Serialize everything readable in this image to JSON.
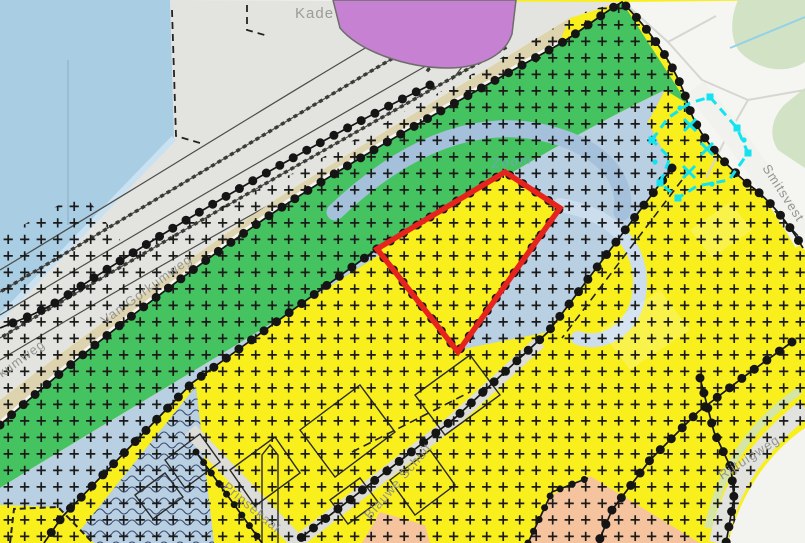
{
  "map": {
    "street_labels": {
      "kade": "Kade",
      "van_gorkumweg": "Van Gorkumweg",
      "van_gorkumweg_2": "Van Gorkumweg",
      "smitsvest": "Smitsvest",
      "rijtuigweg": "Rijtuigweg",
      "prinsekaai": "Prinsekaai",
      "blauwe_schuit": "Blauwe Schuit"
    },
    "water_labels": {
      "zoom_river": "Zoom"
    },
    "colors": {
      "background": "#f2f2ef",
      "water": "#a9cde3",
      "water_fringe": "#c9e1f0",
      "river_band": "#a4c0db",
      "river_band_light": "#ccdeee",
      "railway_yard_gray": "#e3e3e0",
      "quay_beige": "#ddd3ae",
      "green_zone": "#44c360",
      "mixed_blue_zone": "#b9cfe2",
      "residential_yellow": "#f8ef1d",
      "salmon_zone": "#f5c49e",
      "purple_building": "#c681d3",
      "park_green": "#d2e2c4",
      "stream_blue": "#93d2e6",
      "road_gray": "#dcdcd8",
      "verge_green": "#d5e5a5",
      "white_area": "#f5f5f1",
      "boundary_black": "#151515",
      "selected_parcel_red": "#e6231d",
      "measurement_cyan": "#12e4ef",
      "label_gray": "#94948f"
    }
  }
}
